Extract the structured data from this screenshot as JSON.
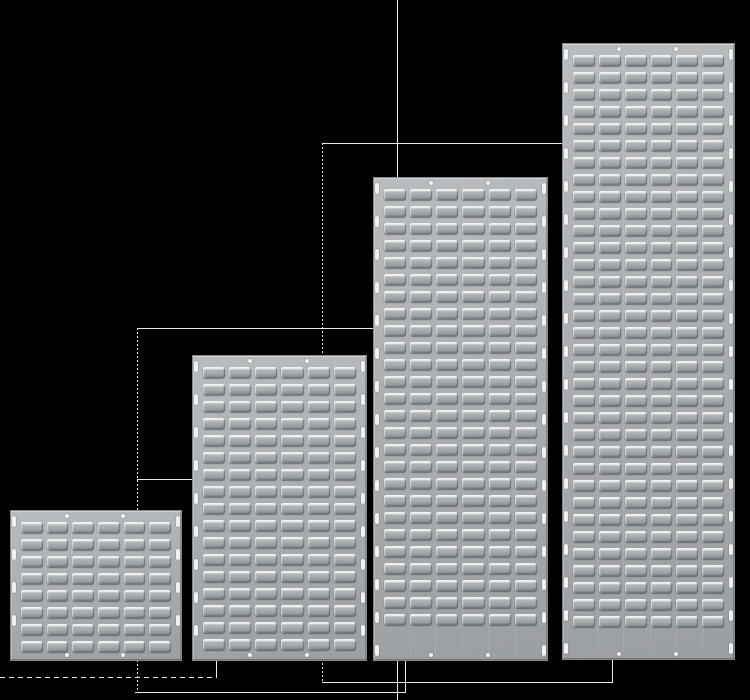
{
  "scene": {
    "width": 750,
    "height": 700,
    "background": "#000000",
    "description": "Four grey steel louvre panels of increasing height arranged in steps, joined by thin white leader lines"
  },
  "colors": {
    "panel_base_light": "#b9bcbe",
    "panel_base_dark": "#9c9fa2",
    "panel_border": "#85888b",
    "louver_highlight": "#f3f5f5",
    "louver_face": "#a7aaad",
    "louver_shadow": "#86898c",
    "slot_white": "#eff1f2",
    "hole_white": "#f2f4f4",
    "leader_line": "#e9e9e9"
  },
  "panels": [
    {
      "name": "louvre-panel-small",
      "x": 10,
      "y": 510,
      "width": 172,
      "height": 151,
      "rows": 8,
      "cols": 6
    },
    {
      "name": "louvre-panel-medium",
      "x": 192,
      "y": 355,
      "width": 175,
      "height": 306,
      "rows": 17,
      "cols": 6
    },
    {
      "name": "louvre-panel-large",
      "x": 373,
      "y": 177,
      "width": 175,
      "height": 484,
      "rows": 26,
      "cols": 6
    },
    {
      "name": "louvre-panel-xlarge",
      "x": 562,
      "y": 43,
      "width": 173,
      "height": 617,
      "rows": 34,
      "cols": 6
    }
  ],
  "panel_details": {
    "side_slot_start": 5,
    "side_slot_pitch": 33,
    "row_pitch": 17,
    "hole_positions_pct": [
      33,
      66
    ]
  },
  "leader_lines": [
    {
      "name": "leader-line-center-vertical",
      "orientation": "vertical",
      "x": 397,
      "y": 0,
      "length": 700,
      "style": "solid"
    },
    {
      "name": "leader-line-top-horizontal",
      "orientation": "horizontal",
      "x": 322,
      "y": 143,
      "length": 240,
      "style": "solid"
    },
    {
      "name": "leader-line-mid-vertical",
      "orientation": "vertical",
      "x": 322,
      "y": 143,
      "length": 539,
      "style": "dotted"
    },
    {
      "name": "leader-line-mid-horizontal",
      "orientation": "horizontal",
      "x": 137,
      "y": 328,
      "length": 237,
      "style": "solid"
    },
    {
      "name": "leader-line-left-vertical",
      "orientation": "vertical",
      "x": 137,
      "y": 328,
      "length": 364,
      "style": "dotted"
    },
    {
      "name": "leader-line-small-horizontal",
      "orientation": "horizontal",
      "x": 137,
      "y": 479,
      "length": 55,
      "style": "solid"
    },
    {
      "name": "leader-line-bottom-right-horizontal",
      "orientation": "horizontal",
      "x": 322,
      "y": 682,
      "length": 291,
      "style": "solid"
    },
    {
      "name": "leader-line-panel4-bottom-vertical",
      "orientation": "vertical",
      "x": 612,
      "y": 660,
      "length": 23,
      "style": "solid"
    },
    {
      "name": "leader-line-bottom-left-horizontal",
      "orientation": "horizontal",
      "x": 135,
      "y": 692,
      "length": 271,
      "style": "solid"
    },
    {
      "name": "leader-line-panel3-bottom-vertical",
      "orientation": "vertical",
      "x": 405,
      "y": 660,
      "length": 33,
      "style": "solid"
    },
    {
      "name": "leader-line-panel2-bottom-vertical",
      "orientation": "vertical",
      "x": 216,
      "y": 659,
      "length": 19,
      "style": "solid"
    },
    {
      "name": "leader-line-bottom-dashed",
      "orientation": "horizontal",
      "x": 0,
      "y": 677,
      "length": 217,
      "style": "dashed"
    }
  ]
}
